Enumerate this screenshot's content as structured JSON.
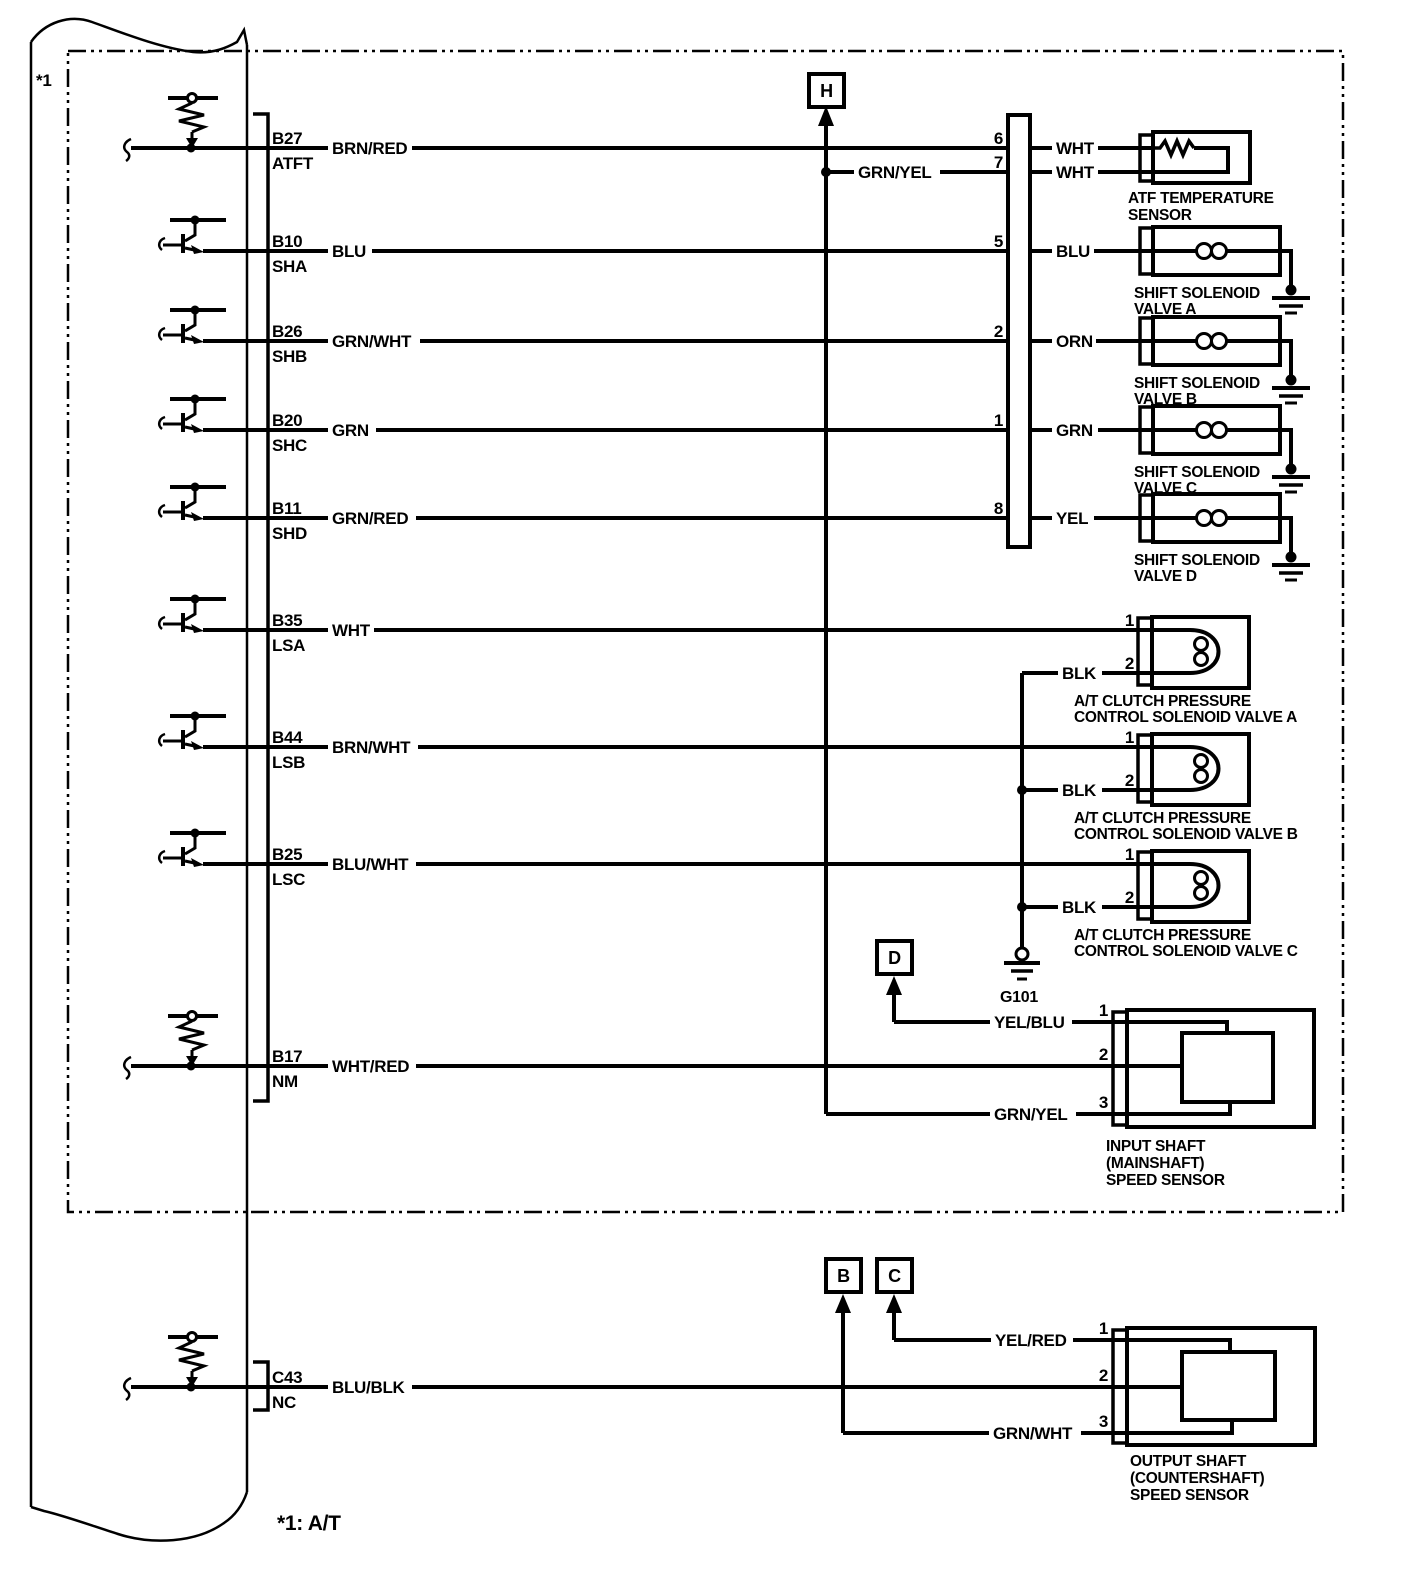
{
  "footnotes": {
    "corner": "*1",
    "bottom": "*1: A/T"
  },
  "connector_refs": {
    "h": "H",
    "d": "D",
    "b": "B",
    "c": "C"
  },
  "ground": {
    "label": "G101"
  },
  "rows": [
    {
      "pin": "B27",
      "signal": "ATFT",
      "color": "BRN/RED"
    },
    {
      "pin": "B10",
      "signal": "SHA",
      "color": "BLU"
    },
    {
      "pin": "B26",
      "signal": "SHB",
      "color": "GRN/WHT"
    },
    {
      "pin": "B20",
      "signal": "SHC",
      "color": "GRN"
    },
    {
      "pin": "B11",
      "signal": "SHD",
      "color": "GRN/RED"
    },
    {
      "pin": "B35",
      "signal": "LSA",
      "color": "WHT"
    },
    {
      "pin": "B44",
      "signal": "LSB",
      "color": "BRN/WHT"
    },
    {
      "pin": "B25",
      "signal": "LSC",
      "color": "BLU/WHT"
    },
    {
      "pin": "B17",
      "signal": "NM",
      "color": "WHT/RED"
    },
    {
      "pin": "C43",
      "signal": "NC",
      "color": "BLU/BLK"
    }
  ],
  "inline_connector": {
    "pins": [
      "6",
      "7",
      "5",
      "2",
      "1",
      "8"
    ]
  },
  "device_wire_colors": [
    "WHT",
    "WHT",
    "BLU",
    "ORN",
    "GRN",
    "YEL"
  ],
  "branch_wires": {
    "grn_yel_top": "GRN/YEL",
    "grn_yel_bottom": "GRN/YEL",
    "yel_blu": "YEL/BLU",
    "yel_red": "YEL/RED",
    "grn_wht": "GRN/WHT",
    "blk_a": "BLK",
    "blk_b": "BLK",
    "blk_c": "BLK"
  },
  "components": {
    "atf_sensor": {
      "line1": "ATF TEMPERATURE",
      "line2": "SENSOR"
    },
    "shift_valve_a": {
      "line1": "SHIFT SOLENOID",
      "line2": "VALVE A"
    },
    "shift_valve_b": {
      "line1": "SHIFT SOLENOID",
      "line2": "VALVE B"
    },
    "shift_valve_c": {
      "line1": "SHIFT SOLENOID",
      "line2": "VALVE C"
    },
    "shift_valve_d": {
      "line1": "SHIFT SOLENOID",
      "line2": "VALVE D"
    },
    "clutch_valve_a": {
      "pin1": "1",
      "pin2": "2",
      "line1": "A/T CLUTCH PRESSURE",
      "line2": "CONTROL SOLENOID VALVE A"
    },
    "clutch_valve_b": {
      "pin1": "1",
      "pin2": "2",
      "line1": "A/T CLUTCH PRESSURE",
      "line2": "CONTROL SOLENOID VALVE B"
    },
    "clutch_valve_c": {
      "pin1": "1",
      "pin2": "2",
      "line1": "A/T CLUTCH PRESSURE",
      "line2": "CONTROL SOLENOID VALVE C"
    },
    "input_sensor": {
      "pin1": "1",
      "pin2": "2",
      "pin3": "3",
      "line1": "INPUT SHAFT",
      "line2": "(MAINSHAFT)",
      "line3": "SPEED SENSOR"
    },
    "output_sensor": {
      "pin1": "1",
      "pin2": "2",
      "pin3": "3",
      "line1": "OUTPUT SHAFT",
      "line2": "(COUNTERSHAFT)",
      "line3": "SPEED SENSOR"
    }
  }
}
